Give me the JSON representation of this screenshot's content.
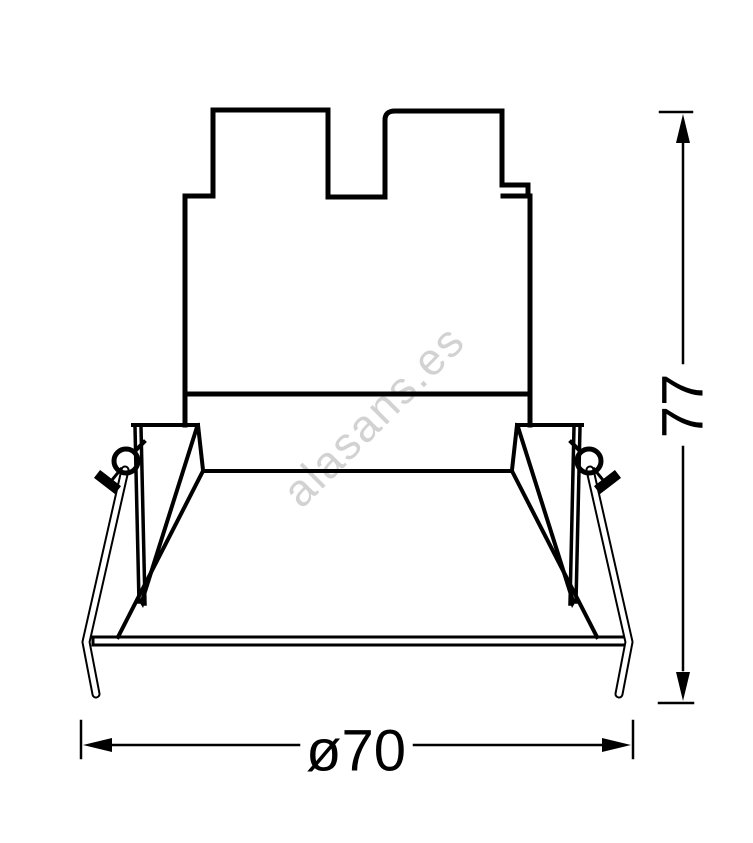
{
  "diagram": {
    "type": "technical-drawing",
    "subject": "recessed-downlight-front-elevation",
    "watermark": {
      "text": "alasans.es",
      "color": "#d2d2d2"
    },
    "dimensions": [
      {
        "id": "width",
        "label": "ø70",
        "orientation": "horizontal"
      },
      {
        "id": "height",
        "label": "77",
        "orientation": "vertical"
      }
    ],
    "colors": {
      "line": "#000000",
      "background": "#ffffff"
    }
  }
}
